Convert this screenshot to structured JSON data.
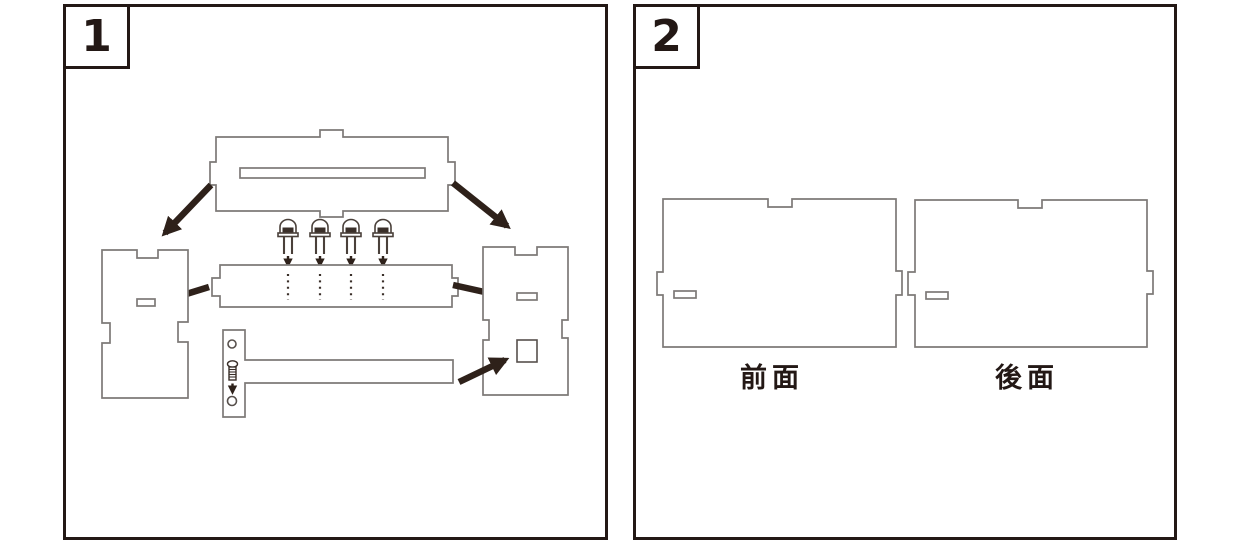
{
  "colors": {
    "frame": "#231815",
    "part_outline": "#7d9777",
    "arrow": "#2e211a",
    "background": "#ffffff"
  },
  "panel1": {
    "number": "1",
    "parts": {
      "top_plate": "top-plate-with-slot",
      "led_count": 4,
      "middle_plate": "led-mounting-plate",
      "left_side": "left-side-panel",
      "right_side": "right-side-panel",
      "t_piece": "t-shaped-base-with-screw-holes",
      "fasteners": "screw"
    }
  },
  "panel2": {
    "number": "2",
    "front_label": "前面",
    "back_label": "後面"
  }
}
